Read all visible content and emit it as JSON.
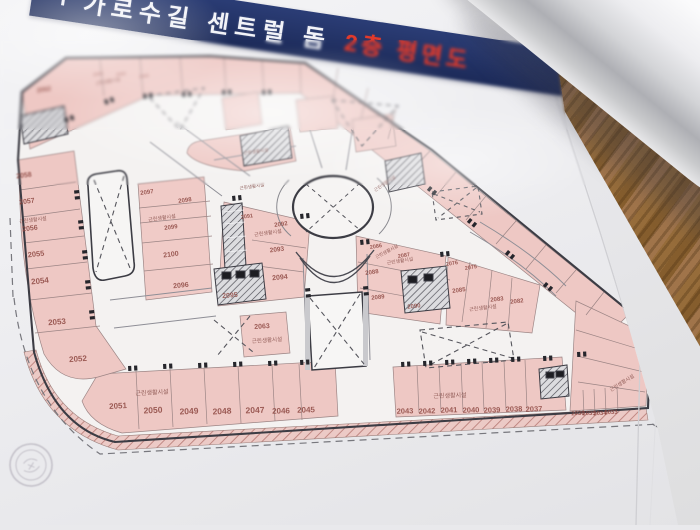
{
  "banner": {
    "title": "가로수길 센트럴 돔",
    "subtitle": "2층 평면도"
  },
  "floorplan": {
    "facility_label": "근린생활시설",
    "colors": {
      "unit_fill": "#eec8c4",
      "outline": "#3c3c44",
      "number": "#8d4741",
      "banner_bg": "#22305f",
      "banner_red": "#e23a2b"
    },
    "units": [
      {
        "id": "2058",
        "x": 24,
        "y": 176,
        "s": 7,
        "r": -7
      },
      {
        "id": "2057",
        "x": 27,
        "y": 202,
        "s": 7,
        "r": -7
      },
      {
        "id": "2056",
        "x": 30,
        "y": 229,
        "s": 7,
        "r": -7
      },
      {
        "id": "2055",
        "x": 36,
        "y": 254,
        "s": 7.5,
        "r": -6
      },
      {
        "id": "2054",
        "x": 40,
        "y": 281,
        "s": 8,
        "r": -6
      },
      {
        "id": "2053",
        "x": 57,
        "y": 322,
        "s": 8,
        "r": -5
      },
      {
        "id": "2052",
        "x": 78,
        "y": 359,
        "s": 8,
        "r": -4
      },
      {
        "id": "2051",
        "x": 118,
        "y": 406,
        "s": 8,
        "r": -3
      },
      {
        "id": "2050",
        "x": 153,
        "y": 410,
        "s": 8.5,
        "r": -3
      },
      {
        "id": "2049",
        "x": 189,
        "y": 411,
        "s": 8.5,
        "r": -3
      },
      {
        "id": "2048",
        "x": 222,
        "y": 411,
        "s": 8.5,
        "r": -3
      },
      {
        "id": "2047",
        "x": 255,
        "y": 410,
        "s": 8.5,
        "r": -2
      },
      {
        "id": "2046",
        "x": 281,
        "y": 411,
        "s": 8,
        "r": -2
      },
      {
        "id": "2045",
        "x": 306,
        "y": 410,
        "s": 8,
        "r": -2
      },
      {
        "id": "2043",
        "x": 405,
        "y": 411,
        "s": 7.5,
        "r": -2
      },
      {
        "id": "2042",
        "x": 427,
        "y": 411,
        "s": 7.5,
        "r": -2
      },
      {
        "id": "2041",
        "x": 449,
        "y": 410,
        "s": 7.5,
        "r": -2
      },
      {
        "id": "2040",
        "x": 471,
        "y": 410,
        "s": 7.5,
        "r": -2
      },
      {
        "id": "2039",
        "x": 492,
        "y": 410,
        "s": 7.5,
        "r": -2
      },
      {
        "id": "2038",
        "x": 514,
        "y": 409,
        "s": 7.5,
        "r": -2
      },
      {
        "id": "2037",
        "x": 534,
        "y": 409,
        "s": 7.5,
        "r": -2
      },
      {
        "id": "2036",
        "x": 578,
        "y": 414,
        "s": 6,
        "r": -3
      },
      {
        "id": "2035",
        "x": 589,
        "y": 414,
        "s": 6,
        "r": -3
      },
      {
        "id": "2034",
        "x": 600,
        "y": 414,
        "s": 6,
        "r": -3
      },
      {
        "id": "2033",
        "x": 611,
        "y": 413,
        "s": 6,
        "r": -3
      },
      {
        "id": "2097",
        "x": 147,
        "y": 193,
        "s": 6,
        "r": -8
      },
      {
        "id": "2098",
        "x": 185,
        "y": 201,
        "s": 6,
        "r": -8
      },
      {
        "id": "2099",
        "x": 171,
        "y": 228,
        "s": 6,
        "r": -8
      },
      {
        "id": "2100",
        "x": 171,
        "y": 255,
        "s": 7,
        "r": -7
      },
      {
        "id": "2096",
        "x": 181,
        "y": 286,
        "s": 7,
        "r": -6
      },
      {
        "id": "2091",
        "x": 247,
        "y": 217,
        "s": 5.5,
        "r": -8
      },
      {
        "id": "2092",
        "x": 281,
        "y": 225,
        "s": 6,
        "r": -8
      },
      {
        "id": "2093",
        "x": 277,
        "y": 250,
        "s": 6.5,
        "r": -7
      },
      {
        "id": "2094",
        "x": 280,
        "y": 278,
        "s": 7,
        "r": -6
      },
      {
        "id": "2095",
        "x": 230,
        "y": 296,
        "s": 7,
        "r": -5
      },
      {
        "id": "2063",
        "x": 262,
        "y": 327,
        "s": 7,
        "r": -4
      },
      {
        "id": "2086",
        "x": 376,
        "y": 247,
        "s": 5.5,
        "r": -9
      },
      {
        "id": "2087",
        "x": 404,
        "y": 256,
        "s": 5.5,
        "r": -9
      },
      {
        "id": "2088",
        "x": 372,
        "y": 273,
        "s": 6,
        "r": -8
      },
      {
        "id": "2089",
        "x": 378,
        "y": 298,
        "s": 6,
        "r": -6
      },
      {
        "id": "2090",
        "x": 414,
        "y": 307,
        "s": 6,
        "r": -6
      },
      {
        "id": "2076",
        "x": 452,
        "y": 264,
        "s": 5.5,
        "r": -9
      },
      {
        "id": "2075",
        "x": 471,
        "y": 268,
        "s": 5.5,
        "r": -9
      },
      {
        "id": "2085",
        "x": 459,
        "y": 291,
        "s": 6,
        "r": -8
      },
      {
        "id": "2083",
        "x": 497,
        "y": 300,
        "s": 6,
        "r": -6
      },
      {
        "id": "2082",
        "x": 517,
        "y": 302,
        "s": 6,
        "r": -6
      },
      {
        "id": "2062",
        "x": 44,
        "y": 90,
        "s": 6.5,
        "r": -9
      },
      {
        "id": "2064",
        "x": 98,
        "y": 74,
        "s": 4.5,
        "r": -9,
        "faint": true
      },
      {
        "id": "2065",
        "x": 121,
        "y": 74,
        "s": 4.5,
        "r": -9,
        "faint": true
      },
      {
        "id": "2066",
        "x": 144,
        "y": 76,
        "s": 4.5,
        "r": -9,
        "faint": true
      }
    ],
    "facility_positions": [
      {
        "x": 33,
        "y": 220,
        "s": 5,
        "r": -7
      },
      {
        "x": 152,
        "y": 392,
        "s": 6,
        "r": -3
      },
      {
        "x": 450,
        "y": 395,
        "s": 6,
        "r": -2
      },
      {
        "x": 622,
        "y": 383,
        "s": 5,
        "r": -32
      },
      {
        "x": 162,
        "y": 218,
        "s": 5,
        "r": -8
      },
      {
        "x": 268,
        "y": 233,
        "s": 5,
        "r": -8
      },
      {
        "x": 267,
        "y": 340,
        "s": 5.5,
        "r": -4
      },
      {
        "x": 400,
        "y": 261,
        "s": 4.8,
        "r": -9
      },
      {
        "x": 483,
        "y": 308,
        "s": 5,
        "r": -7
      },
      {
        "x": 385,
        "y": 184,
        "s": 4.5,
        "r": -34
      },
      {
        "x": 387,
        "y": 252,
        "s": 4.5,
        "r": -28
      },
      {
        "x": 108,
        "y": 82,
        "s": 4.5,
        "r": -10
      },
      {
        "x": 256,
        "y": 152,
        "s": 4.5,
        "r": -8
      },
      {
        "x": 252,
        "y": 187,
        "s": 4.5,
        "r": -8
      }
    ]
  }
}
